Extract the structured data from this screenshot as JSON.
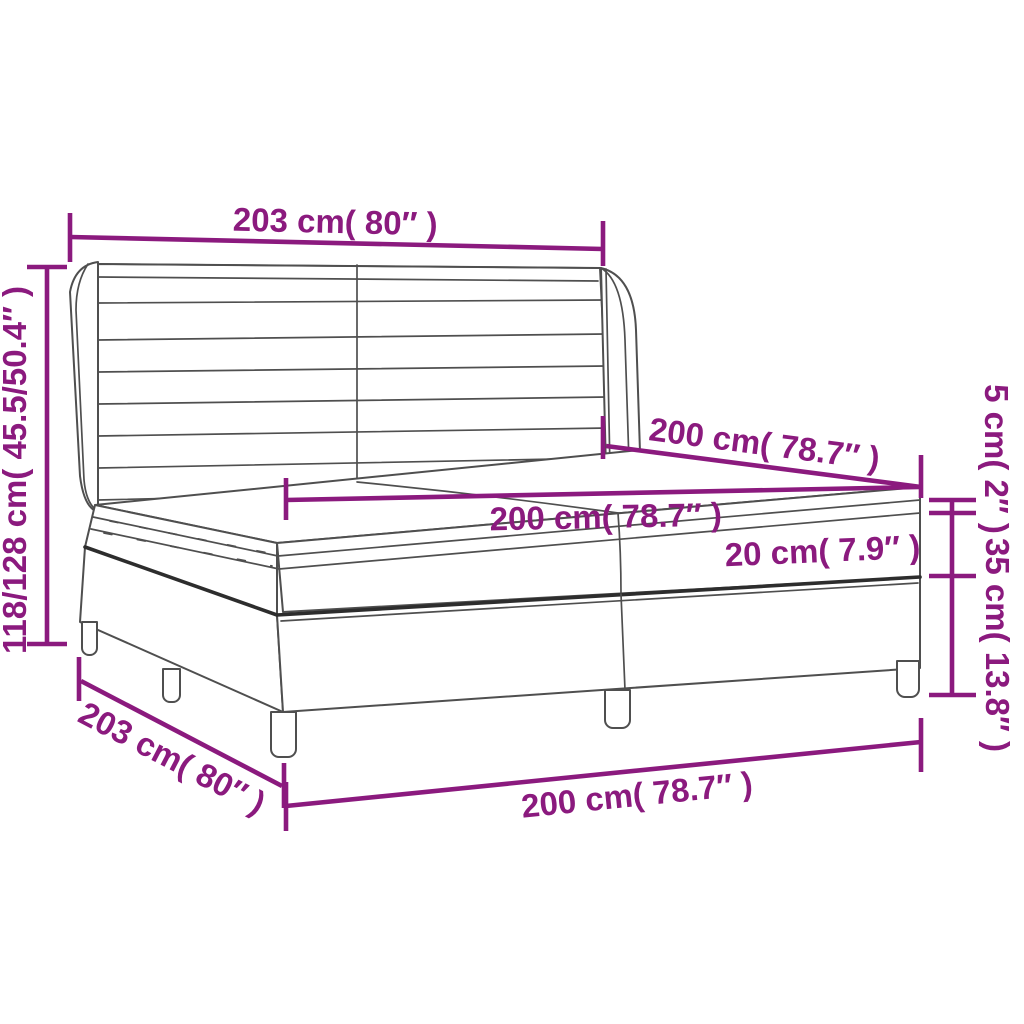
{
  "page": {
    "title": "Box spring bed dimension diagram",
    "background": "#ffffff"
  },
  "diagram": {
    "product": "box-spring-bed-with-headboard-topper-mattress-and-base",
    "accent_color": "#8b1a7e",
    "outline_color": "#4f4f4f"
  },
  "dimensions": {
    "headboard_width": "203 cm( 80″ )",
    "bed_height": "118/128 cm( 45.5/50.4″ )",
    "mattress_width": "200 cm( 78.7″ )",
    "mattress_length": "200 cm( 78.7″ )",
    "mattress_thickness": "20 cm( 7.9″ )",
    "topper_thickness": "5 cm( 2″ )",
    "base_height": "35 cm( 13.8″ )",
    "base_width": "203 cm( 80″ )",
    "base_length": "200 cm( 78.7″ )"
  }
}
